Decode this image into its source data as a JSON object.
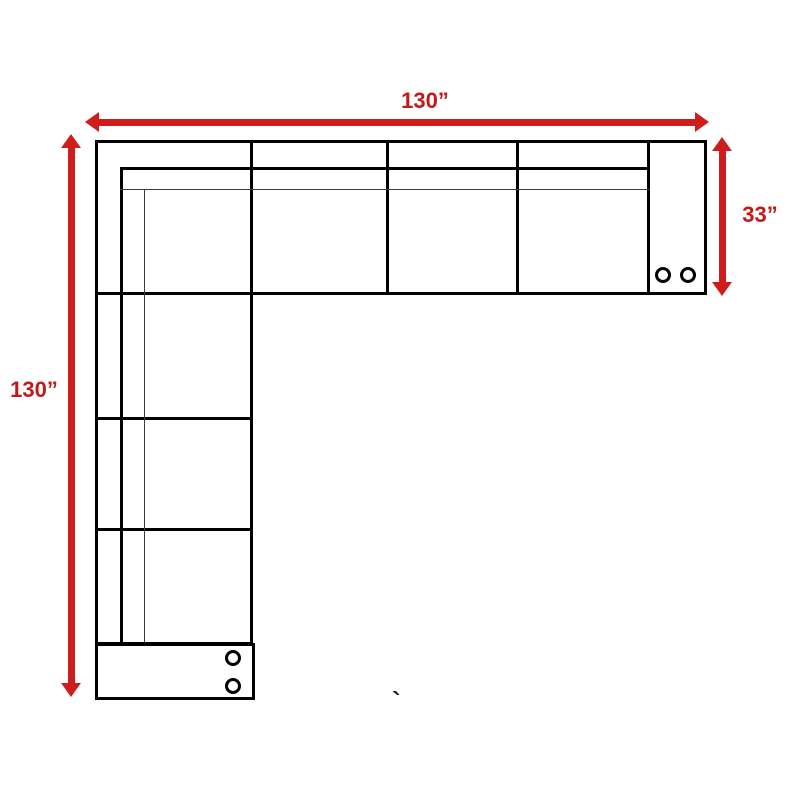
{
  "diagram": {
    "dimensions": {
      "top": {
        "label": "130”"
      },
      "right": {
        "label": "33”"
      },
      "left": {
        "label": "130”"
      }
    },
    "stray_mark": "`",
    "colors": {
      "dimension_red": "#cf1d1d",
      "label_red": "#c21a1a",
      "outline_black": "#000000"
    }
  }
}
